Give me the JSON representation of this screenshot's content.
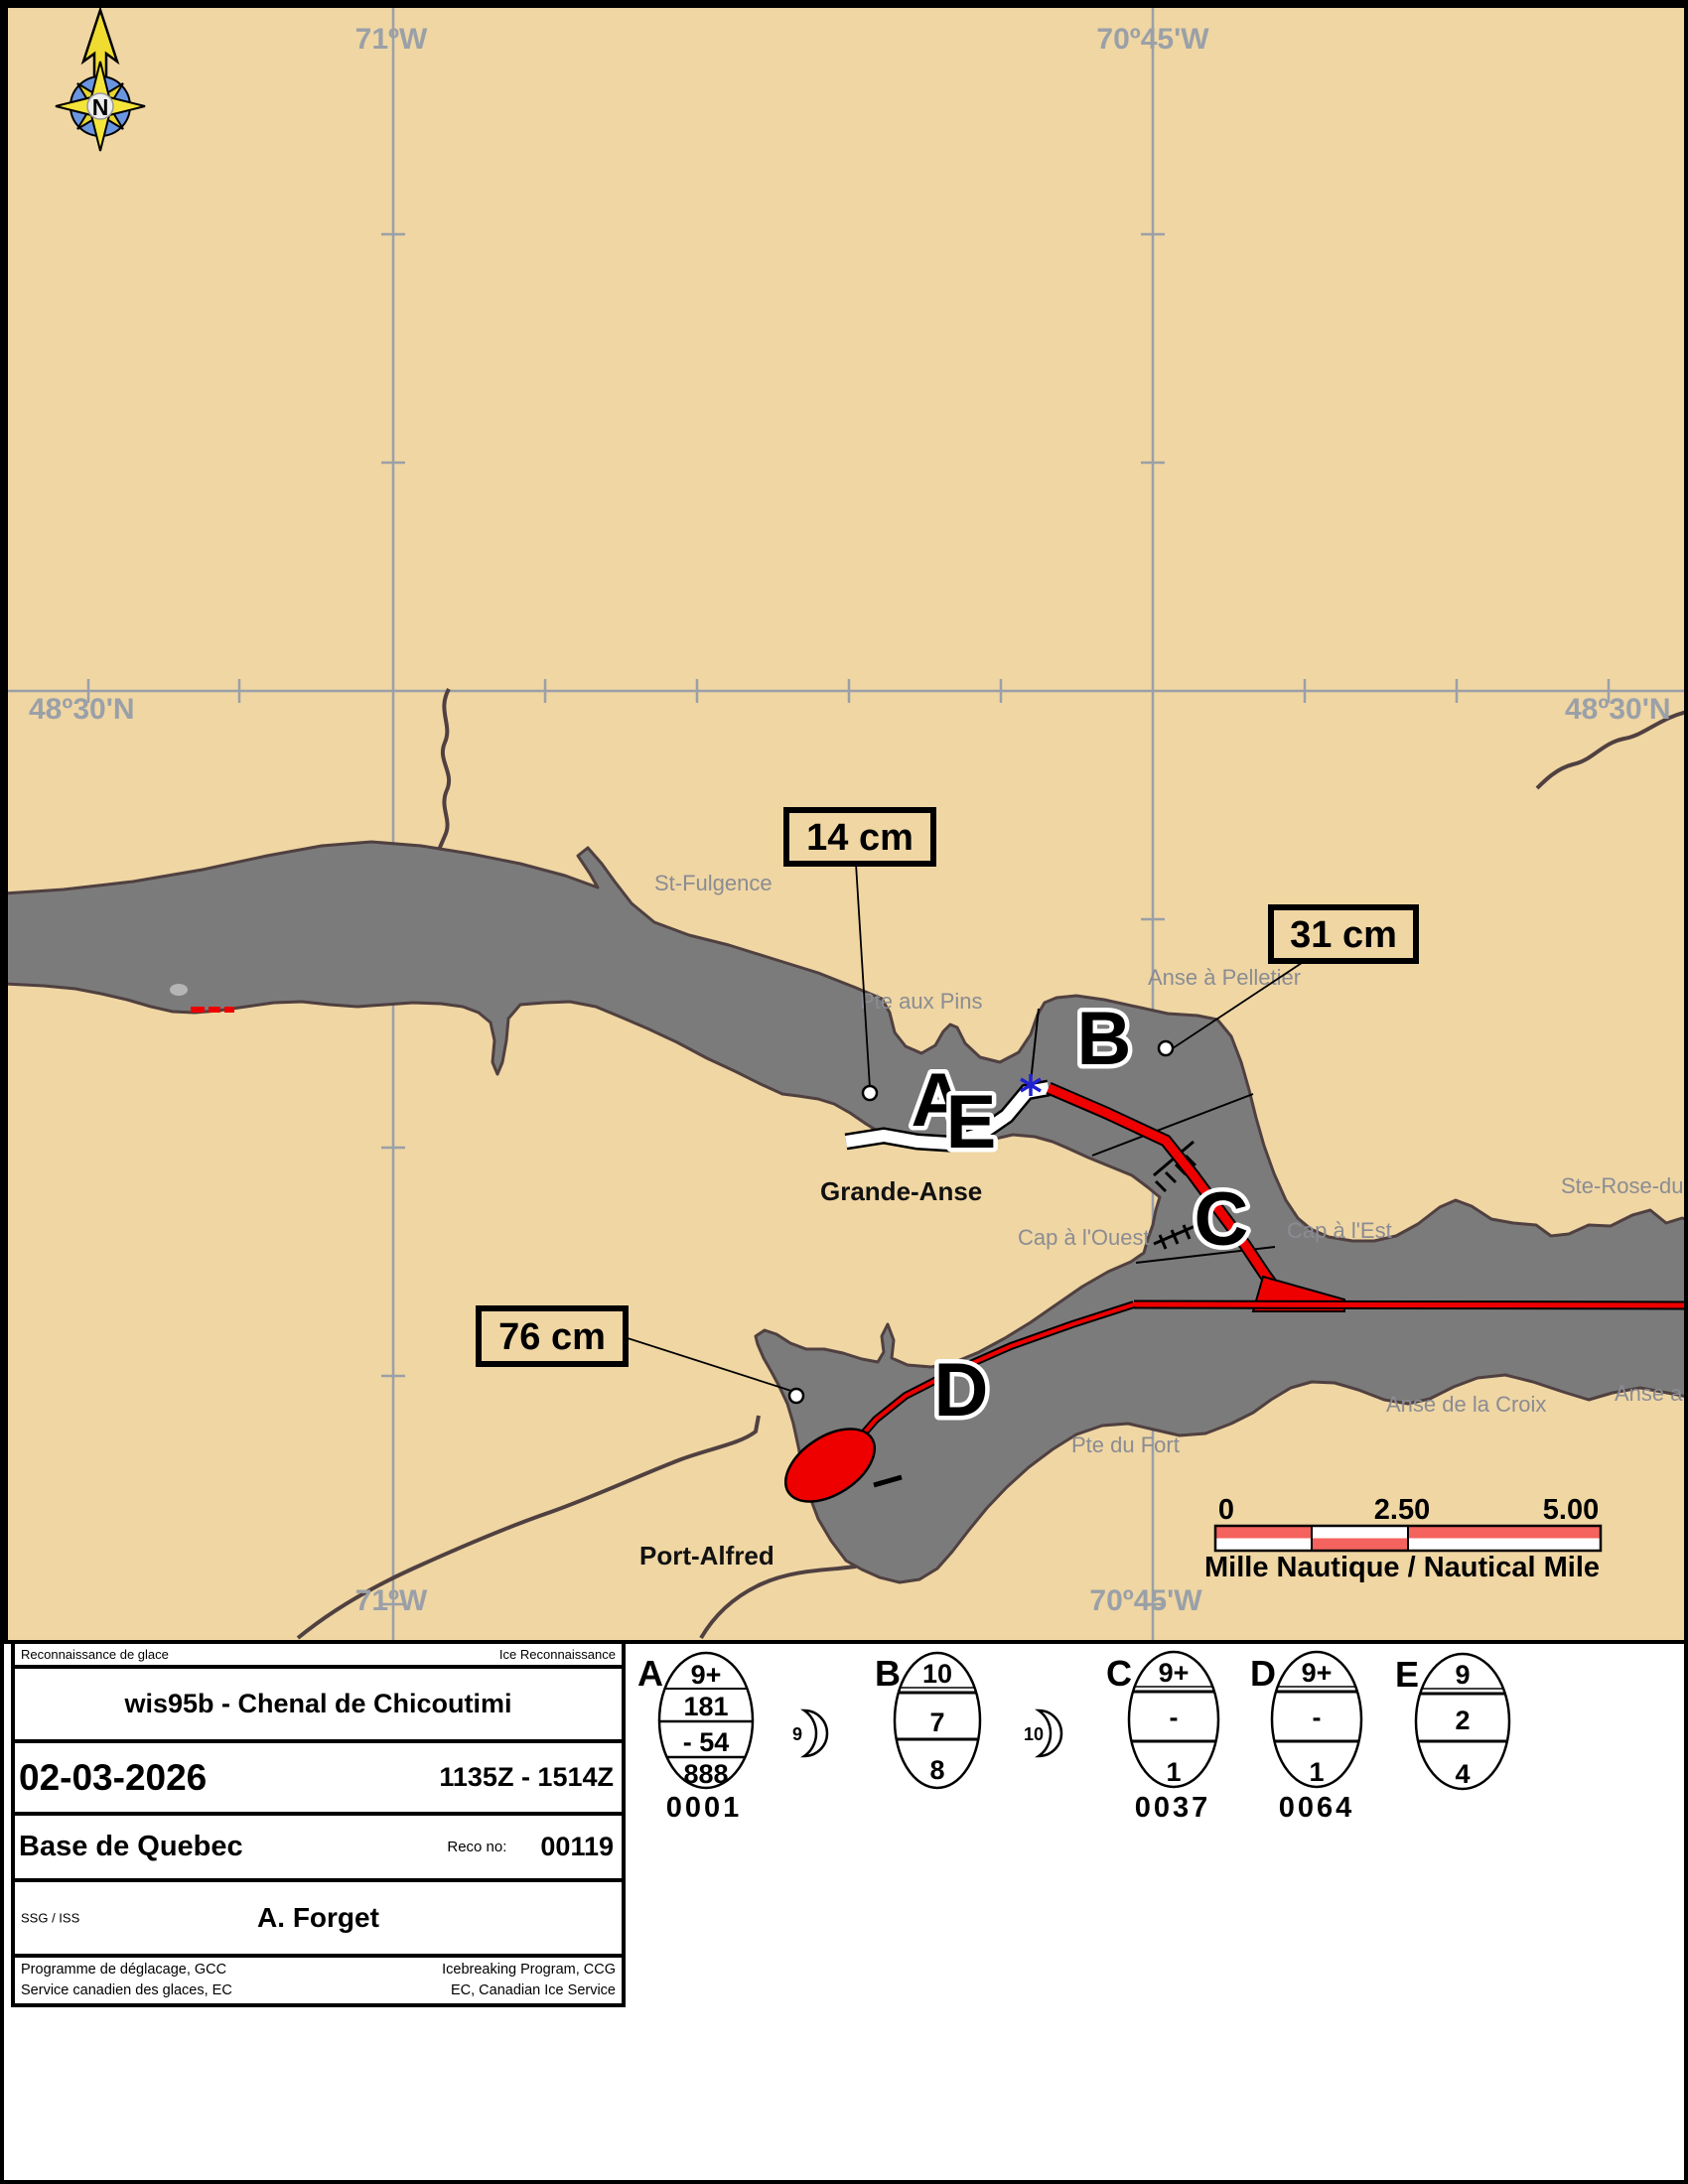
{
  "map": {
    "coordinates": {
      "lon_top_left": "71ºW",
      "lon_top_right": "70º45'W",
      "lat_left": "48º30'N",
      "lat_right": "48º30'N",
      "lon_bottom_left": "71ºW",
      "lon_bottom_right": "70º45'W"
    },
    "compass_n": "N",
    "places": {
      "st_fulgence": "St-Fulgence",
      "pte_aux_pins": "Pte aux Pins",
      "anse_a_pelletier": "Anse à Pelletier",
      "grande_anse": "Grande-Anse",
      "cap_a_l_ouest": "Cap à l'Ouest",
      "cap_a_l_est": "Cap à l'Est",
      "ste_rose": "Ste-Rose-du-N",
      "anse_de_la_croix": "Anse de la Croix",
      "anse_au": "Anse au",
      "pte_du_fort": "Pte du Fort",
      "port_alfred": "Port-Alfred"
    },
    "zones": {
      "a": "A",
      "b": "B",
      "c": "C",
      "d": "D",
      "e": "E"
    },
    "thickness_labels": {
      "t14": "14 cm",
      "t31": "31 cm",
      "t76": "76 cm"
    },
    "scalebar": {
      "start": "0",
      "mid": "2.50",
      "end": "5.00",
      "caption": "Mille Nautique / Nautical Mile"
    }
  },
  "panel": {
    "header_left": "Reconnaissance de glace",
    "header_right": "Ice Reconnaissance",
    "title": "wis95b - Chenal de Chicoutimi",
    "date": "02-03-2026",
    "time_range": "1135Z - 1514Z",
    "base": "Base de Quebec",
    "reco_label": "Reco no:",
    "reco_number": "00119",
    "ssg_label": "SSG / ISS",
    "observer": "A. Forget",
    "footer_left_line1": "Programme de déglacage, GCC",
    "footer_left_line2": "Service canadien des glaces, EC",
    "footer_right_line1": "Icebreaking Program, CCG",
    "footer_right_line2": "EC, Canadian Ice Service"
  },
  "eggs": {
    "a": {
      "label": "A",
      "rows": [
        "9+",
        "181",
        "- 54",
        "888"
      ],
      "code": "0001",
      "moon": "9"
    },
    "b": {
      "label": "B",
      "rows": [
        "10",
        "7",
        "8"
      ],
      "moon": "10"
    },
    "c": {
      "label": "C",
      "rows": [
        "9+",
        "-",
        "1"
      ],
      "code": "0037"
    },
    "d": {
      "label": "D",
      "rows": [
        "9+",
        "-",
        "1"
      ],
      "code": "0064"
    },
    "e": {
      "label": "E",
      "rows": [
        "9",
        "2",
        "4"
      ]
    }
  },
  "colors": {
    "land": "#efd6a3",
    "water": "#7b7b7b",
    "coastline": "#504040",
    "track_red": "#ee0000",
    "scalebar_red": "#f4635e",
    "grid_gray": "#9aa0a8"
  }
}
